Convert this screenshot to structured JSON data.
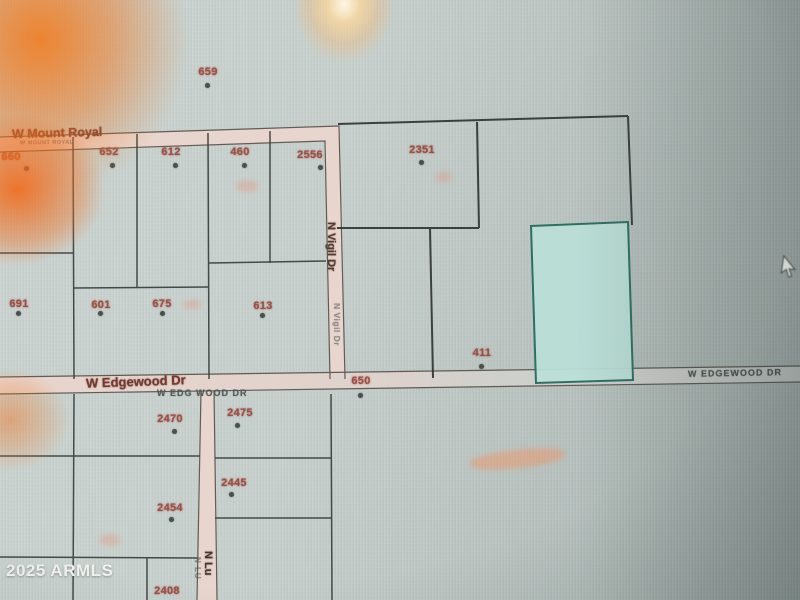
{
  "map": {
    "streets": {
      "mount_royal": "W Mount Royal",
      "mount_royal_caps": "W MOUNT ROYAL",
      "vigil": "N Vigil Dr",
      "vigil_ghost": "N Vigil Dr",
      "edgewood": "W Edgewood Dr",
      "edgewood_caps_left": "W EDG WOOD DR",
      "edgewood_caps_right": "W EDGEWOOD DR",
      "n_lu": "N Lu",
      "n_lu_ghost": "N LU"
    },
    "parcels": [
      {
        "number": "659"
      },
      {
        "number": "660"
      },
      {
        "number": "652"
      },
      {
        "number": "612"
      },
      {
        "number": "460"
      },
      {
        "number": "2556"
      },
      {
        "number": "2351"
      },
      {
        "number": "691"
      },
      {
        "number": "601"
      },
      {
        "number": "675"
      },
      {
        "number": "613"
      },
      {
        "number": "411"
      },
      {
        "number": "650"
      },
      {
        "number": "2470"
      },
      {
        "number": "2475"
      },
      {
        "number": "2445"
      },
      {
        "number": "2454"
      },
      {
        "number": "2408"
      }
    ],
    "highlight_parcel": {
      "fill": "#b9ded7",
      "border": "#2f6f62"
    },
    "colors": {
      "parcel_line": "#3d4240",
      "road_fill": "#e8d5cd",
      "parcel_number": "#9c4f45",
      "street_label": "#743931"
    }
  },
  "watermark": "2025 ARMLS"
}
